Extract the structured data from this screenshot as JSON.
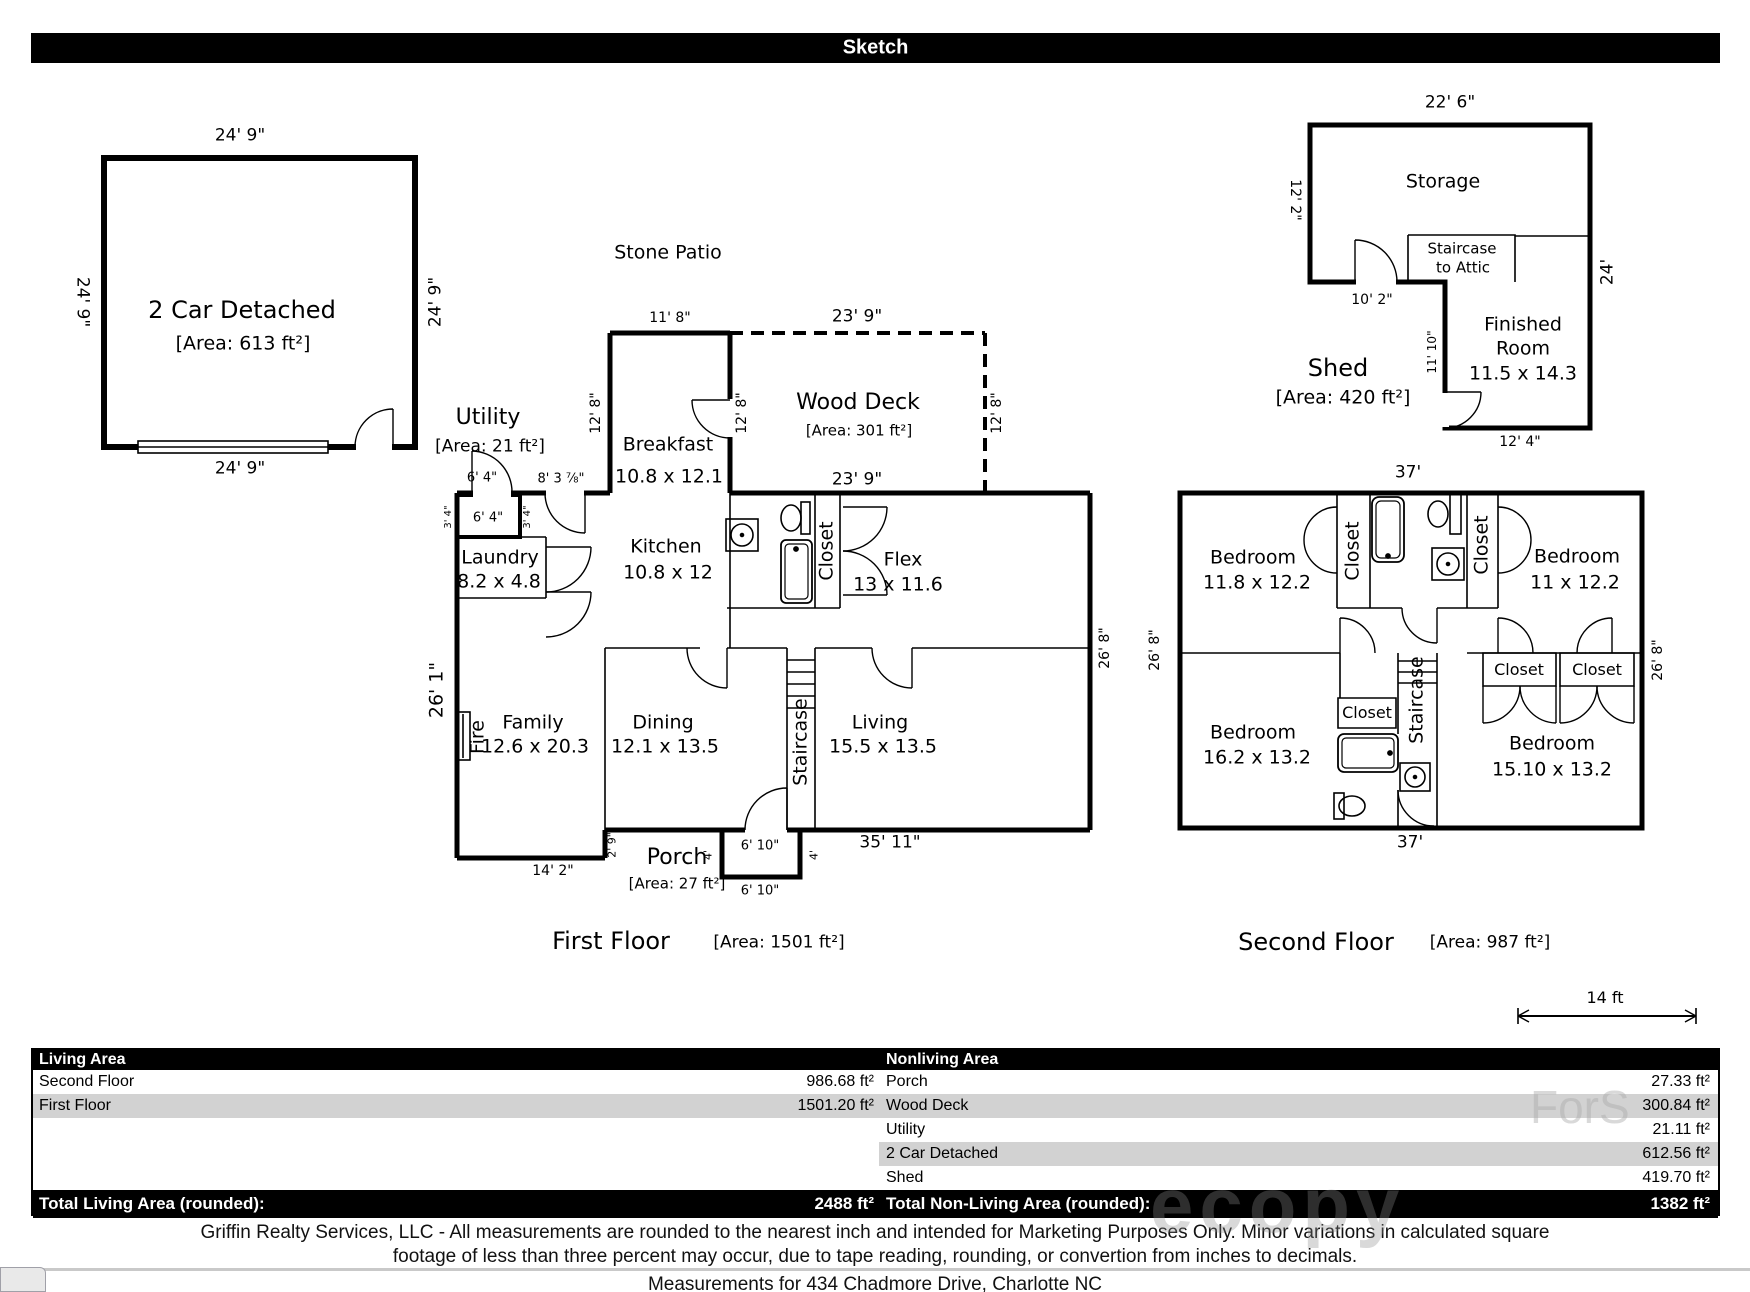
{
  "header": {
    "title": "Sketch"
  },
  "garage": {
    "name": "2 Car Detached",
    "area": "[Area: 613 ft²]",
    "dim_top": "24' 9\"",
    "dim_left": "24' 9\"",
    "dim_right": "24' 9\"",
    "dim_bottom": "24' 9\""
  },
  "first_floor": {
    "title": "First Floor",
    "area_label": "[Area: 1501 ft²]",
    "stone_patio": "Stone Patio",
    "breakfast": {
      "name": "Breakfast",
      "dim": "10.8 x 12.1",
      "top": "11' 8\"",
      "left": "12' 8\"",
      "right": "12' 8\""
    },
    "wood_deck": {
      "name": "Wood Deck",
      "area": "[Area: 301 ft²]",
      "top": "23' 9\"",
      "bottom": "23' 9\"",
      "right": "12' 8\""
    },
    "utility": {
      "name": "Utility",
      "area": "[Area: 21 ft²]",
      "door_width": "6' 4\"",
      "wall_width": "8' 3 ⅞\"",
      "inner_width": "6' 4\"",
      "side_left": "3' 4\"",
      "side_right": "3' 4\""
    },
    "laundry": {
      "name": "Laundry",
      "dim": "8.2 x 4.8"
    },
    "kitchen": {
      "name": "Kitchen",
      "dim": "10.8 x 12"
    },
    "closet": "Closet",
    "flex": {
      "name": "Flex",
      "dim": "13 x 11.6"
    },
    "family": {
      "name": "Family",
      "dim": "12.6 x 20.3"
    },
    "dining": {
      "name": "Dining",
      "dim": "12.1 x 13.5"
    },
    "living": {
      "name": "Living",
      "dim": "15.5 x 13.5"
    },
    "fireplace": "Fire",
    "staircase": "Staircase",
    "dim_left": "26' 1\"",
    "dim_right": "26' 8\"",
    "porch": {
      "name": "Porch",
      "area": "[Area: 27 ft²]",
      "width_top": "6' 10\"",
      "width_bottom": "6' 10\"",
      "side_left": "4'",
      "side_right": "4'",
      "offset": "2' 9\""
    },
    "dim_bottom_right": "35' 11\"",
    "dim_bottom_left": "14' 2\""
  },
  "shed": {
    "name": "Shed",
    "area": "[Area: 420 ft²]",
    "dim_top": "22' 6\"",
    "dim_left": "12' 2\"",
    "dim_right": "24'",
    "storage": "Storage",
    "staircase_line1": "Staircase",
    "staircase_line2": "to Attic",
    "dim_notch": "10' 2\"",
    "dim_inner": "11' 10\"",
    "finished_room_line1": "Finished",
    "finished_room_line2": "Room",
    "finished_room_dim": "11.5 x 14.3",
    "dim_bottom": "12' 4\""
  },
  "second_floor": {
    "title": "Second Floor",
    "area_label": "[Area: 987 ft²]",
    "dim_top": "37'",
    "dim_bottom": "37'",
    "dim_left": "26' 8\"",
    "dim_right": "26' 8\"",
    "bedroom_tl": {
      "name": "Bedroom",
      "dim": "11.8 x 12.2"
    },
    "bedroom_tr": {
      "name": "Bedroom",
      "dim": "11 x 12.2"
    },
    "bedroom_bl": {
      "name": "Bedroom",
      "dim": "16.2 x 13.2"
    },
    "bedroom_br": {
      "name": "Bedroom",
      "dim": "15.10 x 13.2"
    },
    "closet_1": "Closet",
    "closet_2": "Closet",
    "closet_3": "Closet",
    "closet_4": "Closet",
    "closet_5": "Closet",
    "staircase": "Staircase"
  },
  "scale_bar": {
    "label": "14 ft"
  },
  "summary_table": {
    "living_header": "Living Area",
    "nonliving_header": "Nonliving Area",
    "living_rows": [
      {
        "label": "Second Floor",
        "value": "986.68 ft²"
      },
      {
        "label": "First Floor",
        "value": "1501.20 ft²"
      }
    ],
    "nonliving_rows": [
      {
        "label": "Porch",
        "value": "27.33 ft²"
      },
      {
        "label": "Wood Deck",
        "value": "300.84 ft²"
      },
      {
        "label": "Utility",
        "value": "21.11 ft²"
      },
      {
        "label": "2 Car Detached",
        "value": "612.56 ft²"
      },
      {
        "label": "Shed",
        "value": "419.70 ft²"
      }
    ],
    "total_living_label": "Total Living Area (rounded):",
    "total_living_value": "2488 ft²",
    "total_nonliving_label": "Total Non-Living Area (rounded):",
    "total_nonliving_value": "1382 ft²"
  },
  "footer": {
    "disclaimer_line1": "Griffin Realty Services, LLC - All measurements are rounded to the nearest inch and intended for Marketing Purposes Only.  Minor variations in calculated square",
    "disclaimer_line2": "footage of less than three percent may occur, due to tape reading, rounding, or convertion from inches to decimals.",
    "address_note": "Measurements for 434 Chadmore Drive, Charlotte NC"
  },
  "watermark": {
    "fragment1": "ForS",
    "fragment2": "ecopy"
  },
  "colors": {
    "wall": "#000000",
    "table_header_bg": "#000000",
    "row_stripe": "#d2d2d2",
    "divider": "#c9c9c9"
  }
}
